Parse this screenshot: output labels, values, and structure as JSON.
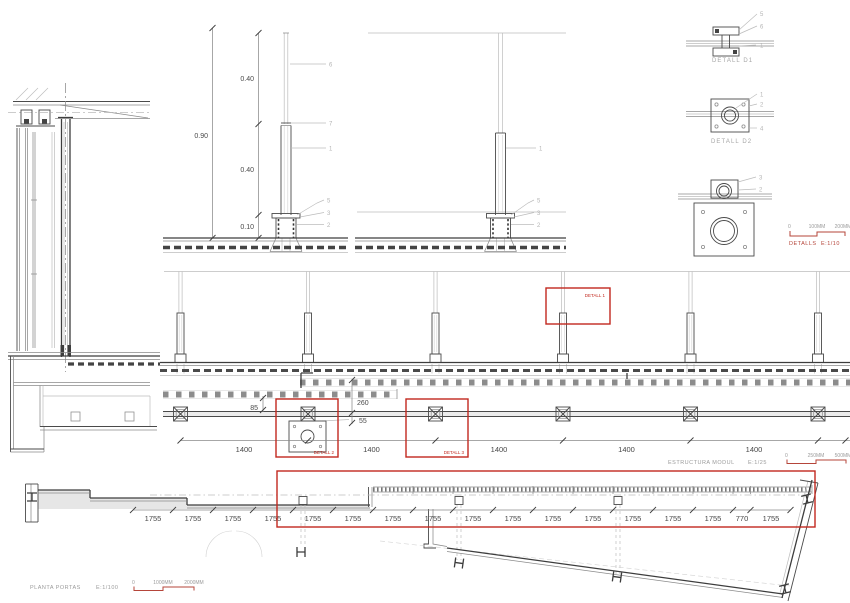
{
  "colors": {
    "highlight_red": "#c2281e",
    "scale_bar_red": "#b5453a"
  },
  "section_detail_a": {
    "dim_overall": "0.90",
    "dim_top": "0.40",
    "dim_mid": "0.40",
    "dim_base": "0.10",
    "callout_rod": "6",
    "callout_joint": "7",
    "callout_post": "1",
    "callout_sleeve": "5",
    "callout_plate": "3",
    "callout_anchor": "2"
  },
  "section_detail_b": {
    "callout_post": "1",
    "callout_sleeve": "5",
    "callout_plate": "3",
    "callout_anchor": "2"
  },
  "detail_d1": {
    "label": "DETALL D1",
    "c1": "5",
    "c2": "6",
    "c3": "1"
  },
  "detail_d2": {
    "label": "DETALL D2",
    "c1": "1",
    "c2": "2",
    "c3": "4"
  },
  "detail_d3": {
    "c1": "3",
    "c2": "2"
  },
  "details_scale": {
    "zero": "0",
    "mid": "100MM",
    "end": "200MM",
    "caption": "DETALLS",
    "ratio": "E:1/10"
  },
  "elevation": {
    "detail_box": "DETALL 1"
  },
  "module_plan": {
    "dim_offset": "85",
    "dim_depth": "260",
    "dim_edge": "55",
    "bays": [
      "1400",
      "1400",
      "1400",
      "1400",
      "1400"
    ],
    "detail_box_left": "DETALL 2",
    "detail_box_right": "DETALL 3",
    "caption": "ESTRUCTURA MODUL",
    "ratio": "E:1/25",
    "scale": {
      "zero": "0",
      "mid": "250MM",
      "end": "500MM"
    }
  },
  "floor_plan": {
    "bays": [
      "1755",
      "1755",
      "1755",
      "1755",
      "1755",
      "1755",
      "1755",
      "1755",
      "1755",
      "1755",
      "1755",
      "1755",
      "1755",
      "1755",
      "1755",
      "770",
      "1755"
    ],
    "caption": "PLANTA PORTAS",
    "ratio": "E:1/100",
    "scale": {
      "zero": "0",
      "mid": "1000MM",
      "end": "2000MM"
    }
  }
}
